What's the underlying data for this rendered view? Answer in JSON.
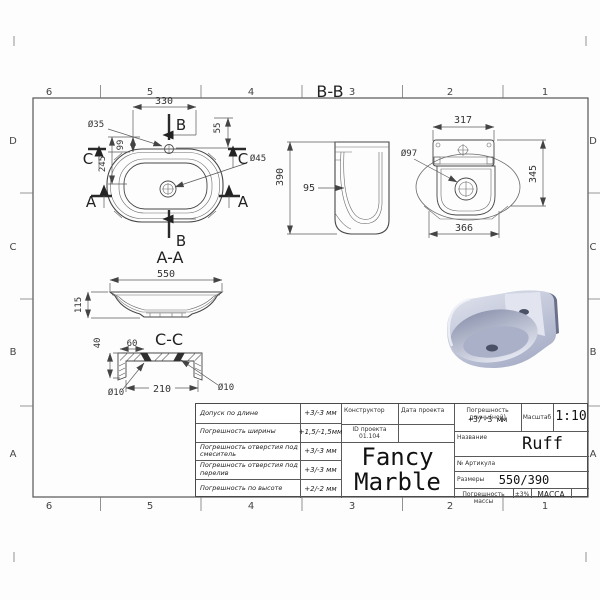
{
  "sheet": {
    "cols": [
      "6",
      "5",
      "4",
      "3",
      "2",
      "1"
    ],
    "rows": [
      "D",
      "C",
      "B",
      "A"
    ]
  },
  "views": {
    "plan": {
      "dim_330": "330",
      "dia_35": "Ø35",
      "dim_55": "55",
      "dim_99": "99",
      "dim_245": "245",
      "dia_45": "Ø45",
      "sec_b_top": "B",
      "sec_b_bottom": "B",
      "sec_a_left": "A",
      "sec_a_right": "A",
      "sec_c_left": "C",
      "sec_c_right": "C"
    },
    "section_bb": {
      "title": "B-B",
      "dim_390": "390",
      "dim_95": "95"
    },
    "bottom_view": {
      "dim_317": "317",
      "dia_97": "Ø97",
      "dim_345": "345",
      "dim_366": "366"
    },
    "section_aa": {
      "title": "A-A",
      "dim_550": "550",
      "dim_115": "115"
    },
    "section_cc": {
      "title": "C-C",
      "dim_40": "40",
      "dim_60": "60",
      "dim_210": "210",
      "dia_10_left": "Ø10",
      "dia_10_right": "Ø10"
    }
  },
  "title_block": {
    "tolerances": [
      {
        "label": "Допуск по длине",
        "value": "+3/-3 мм"
      },
      {
        "label": "Погрешность ширины",
        "value": "+1,5/-1,5мм"
      },
      {
        "label": "Погрешность отверстия под смеситель",
        "value": "+3/-3 мм"
      },
      {
        "label": "Погрешность отверстия под перелив",
        "value": "+3/-3 мм"
      },
      {
        "label": "Погрешность по высоте",
        "value": "+2/-2 мм"
      }
    ],
    "designer_label": "Конструктор",
    "date_label": "Дата проекта",
    "project_id_label": "ID проекта",
    "project_id_value": "01.104",
    "logo_line1": "Fancy",
    "logo_line2": "Marble",
    "length_tol_label": "Погрешность длины(ной)",
    "length_tol_value": "+3/-3 мм",
    "scale_label": "Масштаб",
    "scale_value": "1:10",
    "name_label": "Название",
    "name_value": "Ruff",
    "article_label": "№ Артикула",
    "article_value": "",
    "size_label": "Размеры",
    "size_value": "550/390",
    "mass_tol_label": "Погрешность массы",
    "mass_tol_value": "±3%",
    "mass_label": "МАССА"
  },
  "render_colors": {
    "body_light": "#e2e5ef",
    "body_mid": "#a9b0c8",
    "body_inner_dark": "#8d94ae",
    "body_dark_face": "#697089",
    "hole_dark": "#4a5066"
  }
}
